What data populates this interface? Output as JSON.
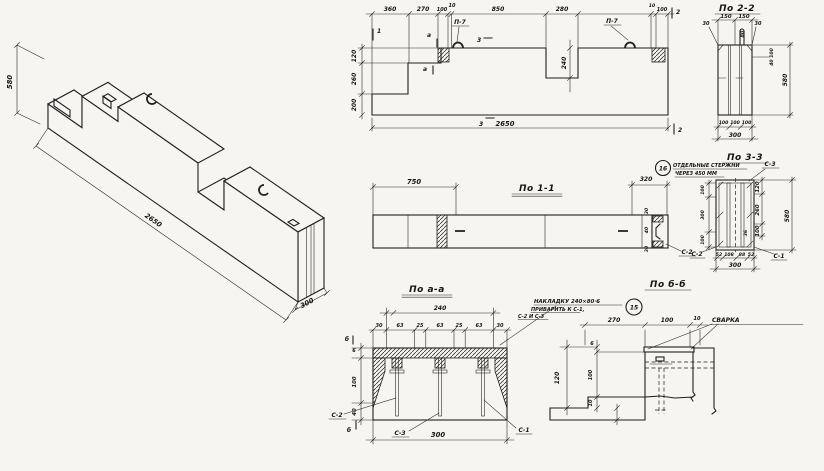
{
  "iso": {
    "dim_height": "580",
    "dim_length": "2650",
    "dim_width": "300"
  },
  "elevation": {
    "top_dims": [
      "360",
      "270",
      "100",
      "10",
      "850",
      "280",
      "10",
      "100"
    ],
    "left_dims": [
      "120",
      "260",
      "200"
    ],
    "recess_depth": "240",
    "total_length": "2650",
    "loop_label_left": "П-7",
    "loop_label_right": "П-7",
    "marks": {
      "m1": "1",
      "m2_top": "2",
      "m2_bottom": "2",
      "ma_top": "а",
      "ma_mid": "а",
      "m3_top": "3",
      "m3_bottom": "3"
    }
  },
  "section_2_2": {
    "title": "По 2-2",
    "top_dims": [
      "150",
      "150"
    ],
    "offset_left": "30",
    "offset_right": "30",
    "dim_80": "80",
    "dim_40_100": "40 100",
    "dim_height": "580",
    "bottom_dims": [
      "100",
      "100",
      "100"
    ],
    "bottom_total": "300"
  },
  "section_1_1": {
    "title": "По 1-1",
    "dim_left": "750",
    "dim_right": "320",
    "note_ref": "16",
    "note_line1": "ОТДЕЛЬНЫЕ СТЕРЖНИ",
    "note_line2": "ЧЕРЕЗ 450 ММ",
    "end_dims": [
      "30",
      "40",
      "30"
    ],
    "label_c2": "С-2"
  },
  "section_3_3": {
    "title": "По 3-3",
    "label_c3": "С-3",
    "label_c2": "С-2",
    "label_c1": "С-1",
    "right_dims": [
      "120",
      "260",
      "100"
    ],
    "right_total": "580",
    "dim_36": "36",
    "left_dims": [
      "100",
      "300",
      "100"
    ],
    "bottom_dims": [
      "52",
      "108",
      "88",
      "52"
    ],
    "bottom_total": "300"
  },
  "section_a_a": {
    "title": "По а-а",
    "dim_240": "240",
    "top_dims": [
      "30",
      "63",
      "25",
      "63",
      "25",
      "63",
      "30"
    ],
    "left_dims": [
      "6",
      "100",
      "40"
    ],
    "mark_b_top": "б",
    "mark_b_bottom": "б",
    "label_c2": "С-2",
    "label_c3": "С-3",
    "label_c1": "С-1",
    "bottom_total": "300",
    "note_line1": "НАКЛАДКУ 240×80·6",
    "note_line2": "ПРИВАРИТЬ К С-1,",
    "note_line3": "С-2 И С-3",
    "note_ref": "15"
  },
  "section_b_b": {
    "title": "По б-б",
    "top_dims": [
      "270",
      "100",
      "10"
    ],
    "weld_label": "СВАРКА",
    "left_total": "120",
    "left_dims": [
      "6",
      "100",
      "10"
    ]
  }
}
